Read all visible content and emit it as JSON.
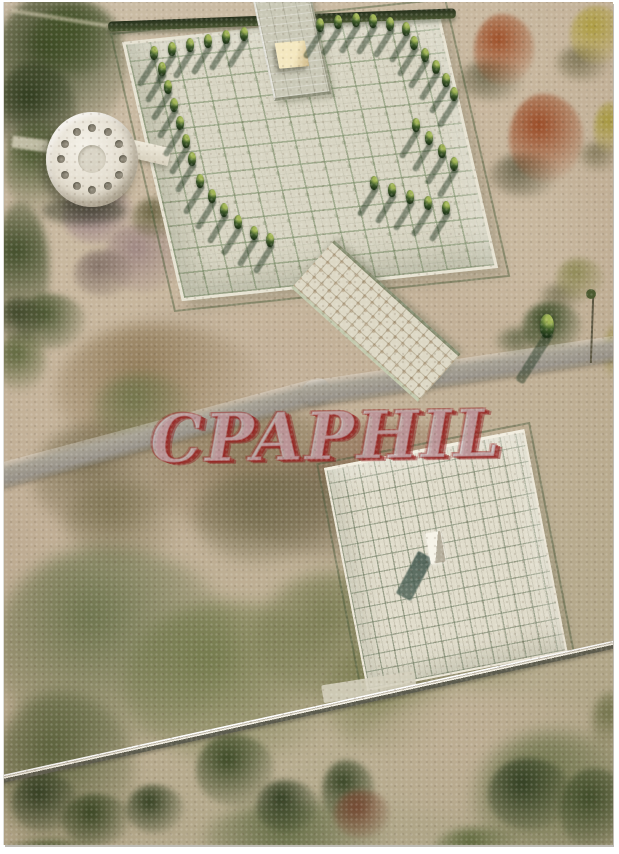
{
  "postcard": {
    "watermark": "CPAPHIL",
    "colors": {
      "watermark_fill": "#ced4da",
      "watermark_red": "#982422",
      "border_white": "#ffffff",
      "gravel": "#c6b6a0",
      "plaza_tile": "#d8d5c3",
      "grout_green": "#739066",
      "path_gray": "#a19c8d",
      "cypress_green": "#2a4420",
      "autumn_red": "#9e4f28",
      "autumn_yellow": "#b0a040",
      "shadow_green": "#3c4a33",
      "wall_white": "#ffffff"
    }
  }
}
